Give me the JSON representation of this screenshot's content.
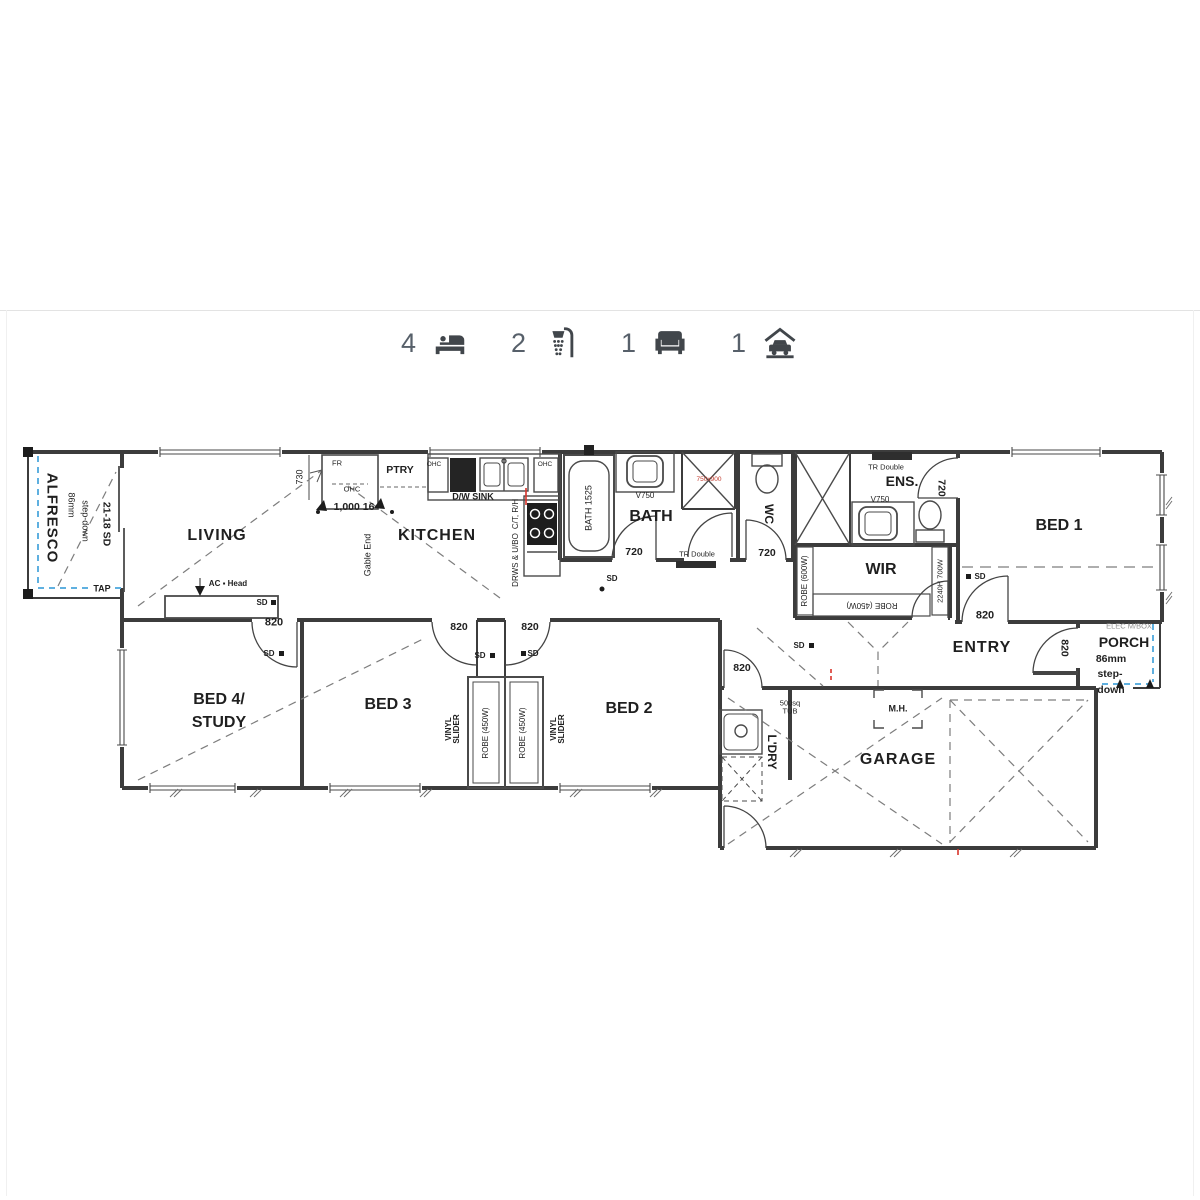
{
  "features": {
    "beds": {
      "count": "4",
      "icon": "bed-icon"
    },
    "showers": {
      "count": "2",
      "icon": "shower-icon"
    },
    "living": {
      "count": "1",
      "icon": "armchair-icon"
    },
    "garage": {
      "count": "1",
      "icon": "garage-icon"
    }
  },
  "plan": {
    "rooms": {
      "alfresco": "ALFRESCO",
      "living": "LIVING",
      "kitchen": "KITCHEN",
      "bath": "BATH",
      "wc": "WC",
      "ens": "ENS.",
      "wir": "WIR",
      "bed1": "BED 1",
      "entry": "ENTRY",
      "porch": "PORCH",
      "bed4_line1": "BED 4/",
      "bed4_line2": "STUDY",
      "bed3": "BED 3",
      "bed2": "BED 2",
      "ldry": "L'DRY",
      "garage": "GARAGE"
    },
    "fixtures": {
      "ptry": "PTRY",
      "fr": "FR",
      "ohc": "OHC",
      "dw_sink": "D/W  SINK",
      "ct_rh": "C/T, R/H",
      "drws_ubo": "DRWS & U/BO",
      "gable_end": "Gable End",
      "bath_tub": "BATH 1525",
      "v750": "V750",
      "tr_double": "TR Double",
      "shower_size": "750x900",
      "robe_600": "ROBE (600W)",
      "robe_450": "ROBE (450W)",
      "robe_2240": "2240H 700W",
      "tub_500": "500sq TUB",
      "mh": "M.H.",
      "ac_head": "AC ▪ Head",
      "tap": "TAP",
      "elec_mbox": "ELEC M/BOX"
    },
    "dims": {
      "d820": "820",
      "d720": "720",
      "d730": "730",
      "d1000": "1,000 16",
      "sd": "SD",
      "sd21": "21-18 SD",
      "stepdown_86": "86mm",
      "stepdown_word": "step-down",
      "porch_86": "86mm",
      "porch_step": "step-",
      "porch_down": "down",
      "vinyl_1": "VINYL",
      "vinyl_2": "SLIDER"
    }
  }
}
